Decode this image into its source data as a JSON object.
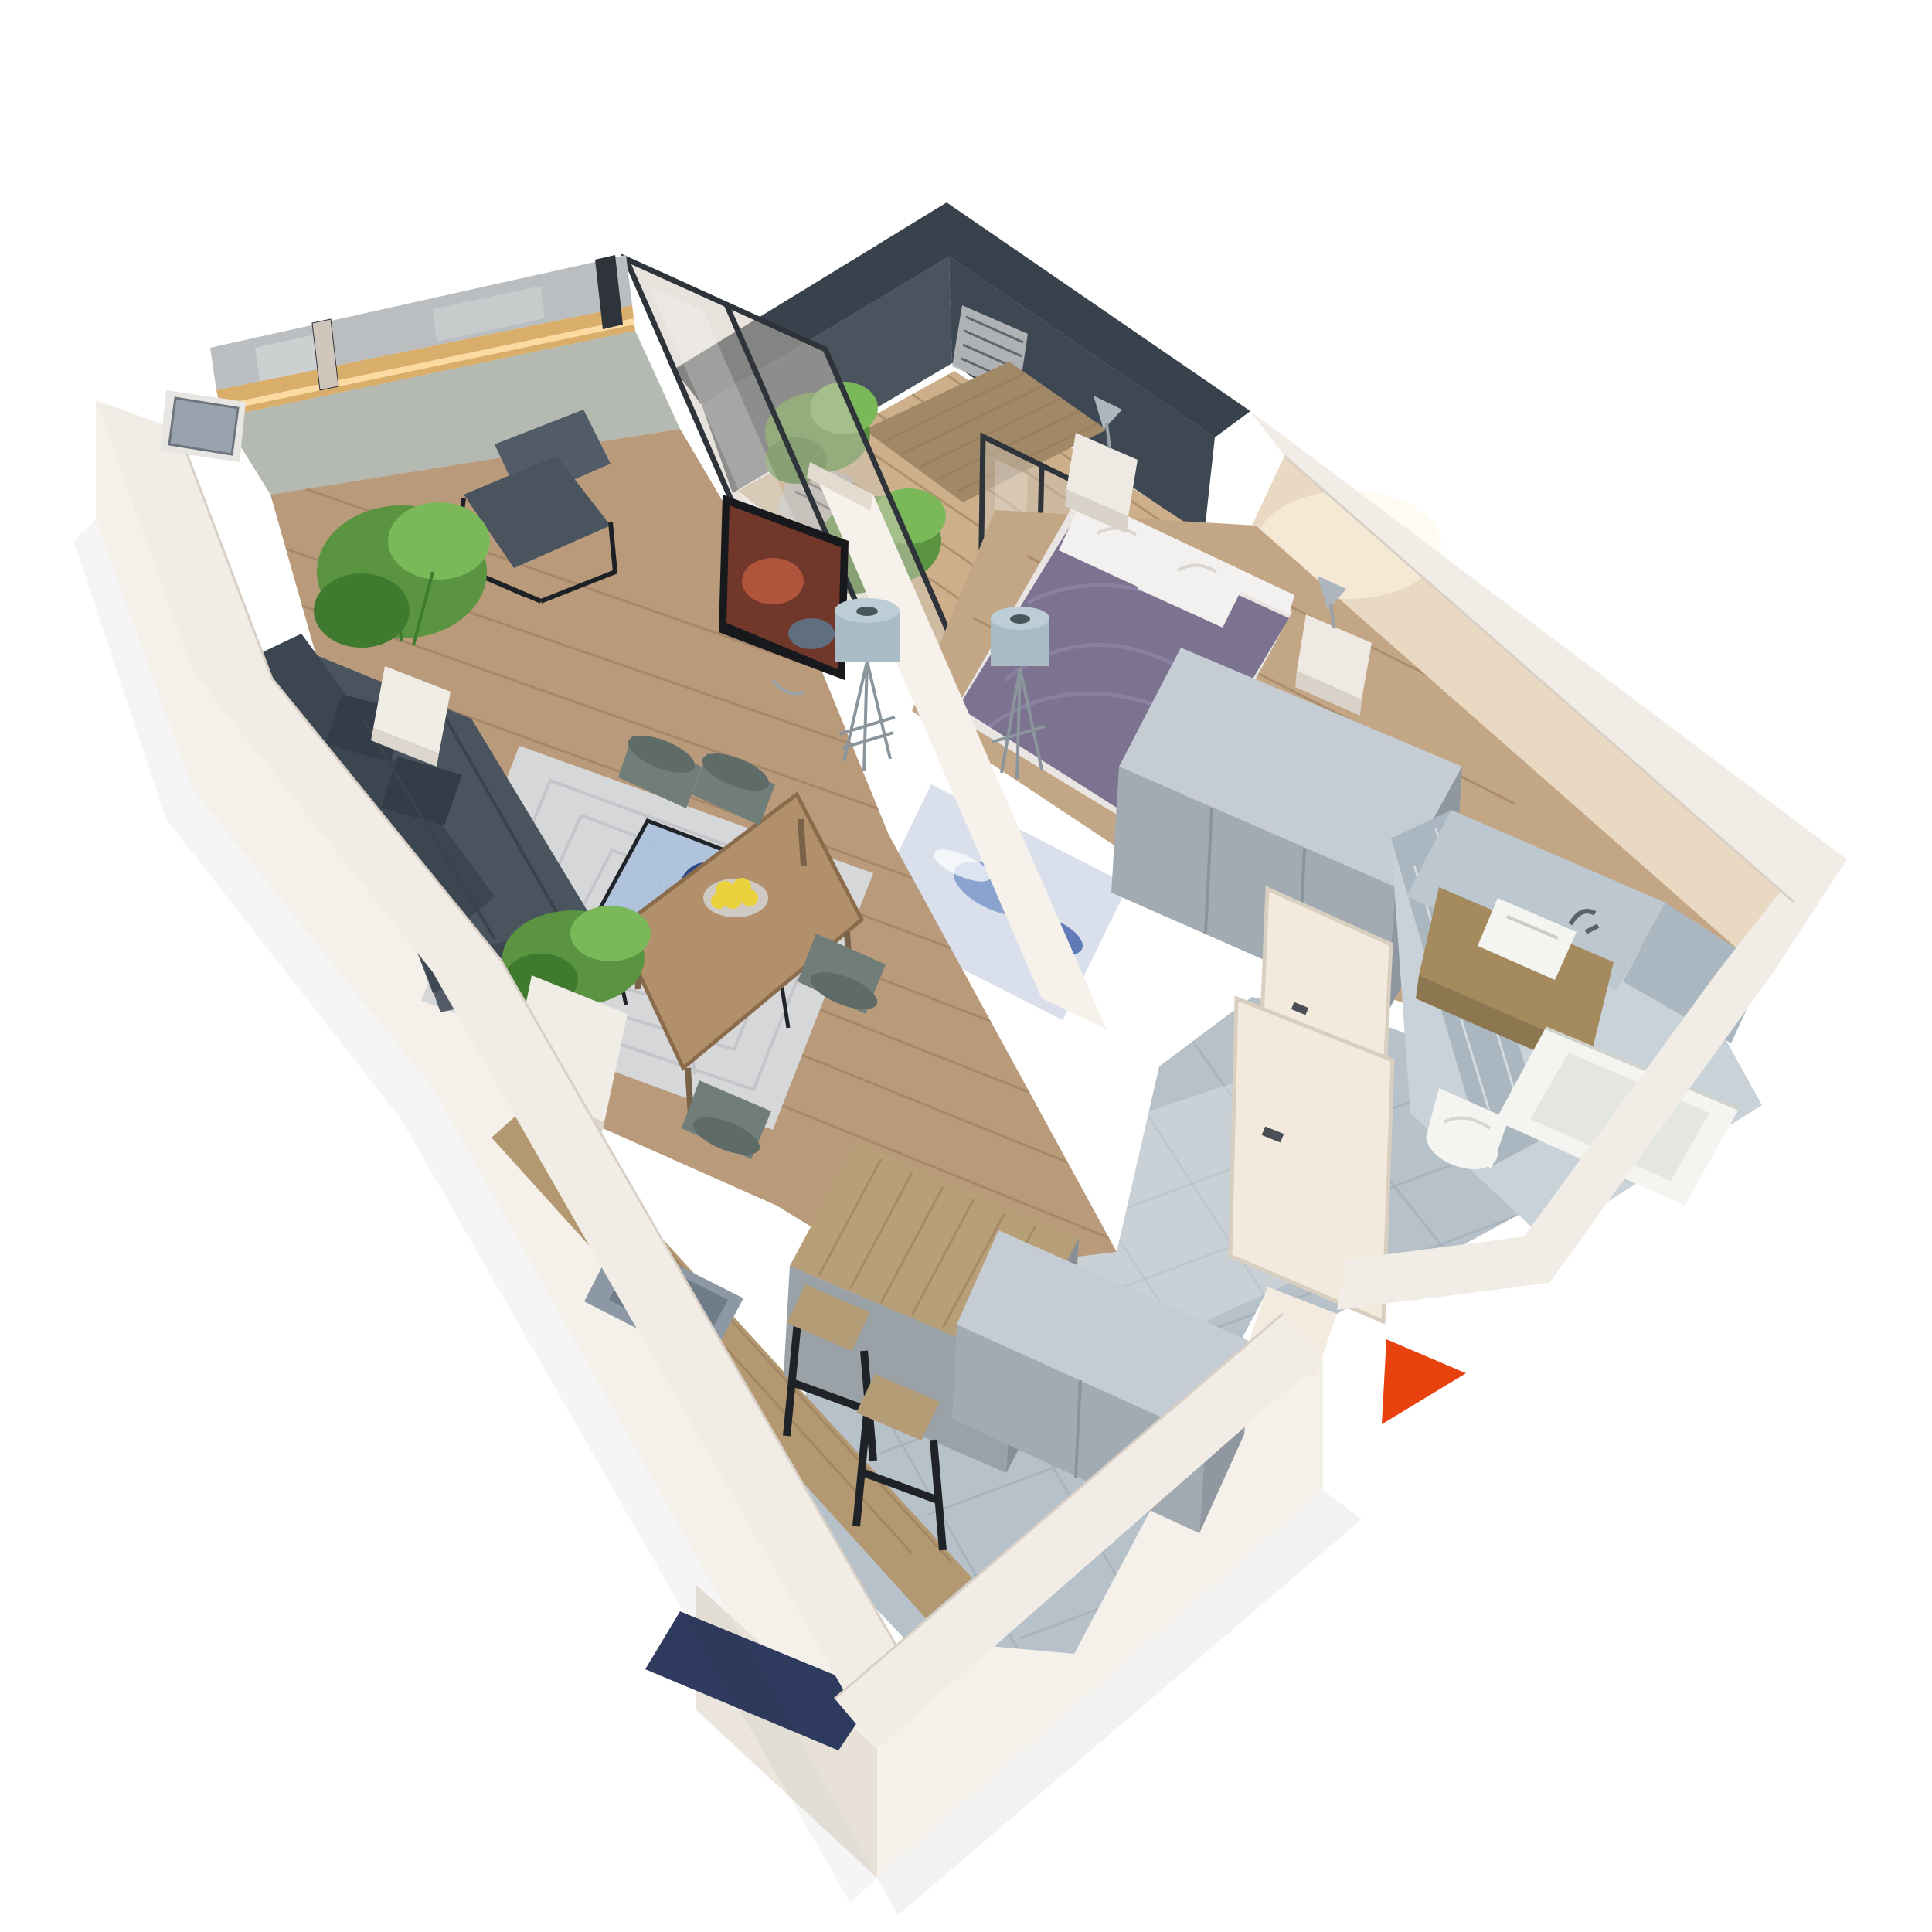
{
  "scene": {
    "kind": "3d-apartment-floor-plan-render",
    "background": "#ffffff",
    "camera": "high-angle perspective, cut-away walls",
    "entrance_marker": {
      "shape": "triangle",
      "points_direction": "right",
      "color": "#e8430f"
    }
  },
  "rooms": [
    {
      "name": "living-room",
      "floor": "wood planks",
      "items": [
        "corner-sofa",
        "armchair",
        "coffee-table-glass",
        "area-rug",
        "tv-on-partition",
        "floor-lamp",
        "potted-plant"
      ]
    },
    {
      "name": "dining-area",
      "floor": "wood planks",
      "items": [
        "dining-table",
        "four-chairs",
        "bowl-of-lemons",
        "planter-box"
      ]
    },
    {
      "name": "kitchen",
      "floor": "gray marble tile",
      "items": [
        "counter-with-sink",
        "island",
        "two-bar-stools",
        "navy-mat"
      ]
    },
    {
      "name": "balcony",
      "floor": "wood decking",
      "items": [
        "outdoor-table",
        "metal-chairs",
        "plants",
        "glass-partitions",
        "dark-slate-walls"
      ]
    },
    {
      "name": "bedroom",
      "floor": "wood planks",
      "items": [
        "double-bed-purple-duvet",
        "white-pillows",
        "two-nightstands",
        "cone-lamps",
        "wardrobe",
        "blue-rug",
        "floor-lamp"
      ]
    },
    {
      "name": "hallway-entrance",
      "floor": "gray marble tile",
      "items": [
        "entrance-door-open",
        "shoe-cabinet",
        "bathroom-door-open"
      ]
    },
    {
      "name": "bathroom",
      "floor": "gray marble tile",
      "items": [
        "wood-vanity",
        "vessel-sink",
        "toilet",
        "bathtub",
        "marble-walls"
      ]
    }
  ],
  "colors": {
    "bg": "#ffffff",
    "wall_top": "#f1ece5",
    "wall_outer": "#f5f1ea",
    "wall_inner": "#e7ded4",
    "wall_shadow": "#e2dacf",
    "accent_arrow": "#e8430f",
    "wood_floor": "#b99b7c",
    "wood_line": "#96795a",
    "wood_bedroom": "#c3a685",
    "wood_balcony": "#cdb08b",
    "marble_floor": "#b7c1c9",
    "marble_line": "#9fabb5",
    "marble_light": "#c9d2d8",
    "slate_dark": "#38424c",
    "slate_mid": "#49545e",
    "slate_deep": "#3e4852",
    "glass_tint": "#cfc5ba",
    "glass_frame": "#2e343a",
    "glass_reflect": "#babec0",
    "low_wall": "#b4b9b1",
    "sill_wood": "#d9ad6a",
    "glow": "#ffdfa8",
    "rug": "#d6d7d9",
    "rug_line": "#c2c3c6",
    "sofa": "#49545f",
    "sofa_dark": "#3c4651",
    "pillow_dark": "#333d48",
    "table_wood": "#b2906c",
    "chair_green": "#707d78",
    "lemon": "#e9d23c",
    "glass_table": "#a9c0dc",
    "vase": "#2c4b86",
    "counter_wood": "#b39872",
    "sink": "#8c98a4",
    "island_top": "#b79f78",
    "island_base": "#9aa1a7",
    "island_side": "#878e95",
    "stool_leg": "#1f2327",
    "duvet": "#7b7390",
    "duvet_line": "#938bae",
    "pillow": "#f3f1ef",
    "mattress": "#e8e5e2",
    "beige_wall": "#e9d8c2",
    "nightstand": "#eee9e3",
    "chrome": "#aeb6bd",
    "wardrobe_top": "#c6ccd3",
    "wardrobe_front": "#a2aab2",
    "wardrobe_side": "#8f97a0",
    "door_cream": "#f3eadd",
    "porch": "#f4ebe0",
    "tile_wall": "#aab6c0",
    "tile_wall_light": "#bcc7cf",
    "vanity_wood": "#a58a5e",
    "fixture_white": "#f4f4f1",
    "rug_blue": "#d9e0ec",
    "rug_blue_accent": "#8ba3cf",
    "mat_navy": "#2f3b5e",
    "plant": "#5a9440",
    "plant_dark": "#3f7a2e",
    "plant_light": "#7bb85a",
    "planter": "#f0ece6",
    "tv": "#17191d",
    "tv_screen": "#7c3b2e",
    "lamp_cyl": "#a9bcc6",
    "lamp_cyl_top": "#bccdd5"
  }
}
